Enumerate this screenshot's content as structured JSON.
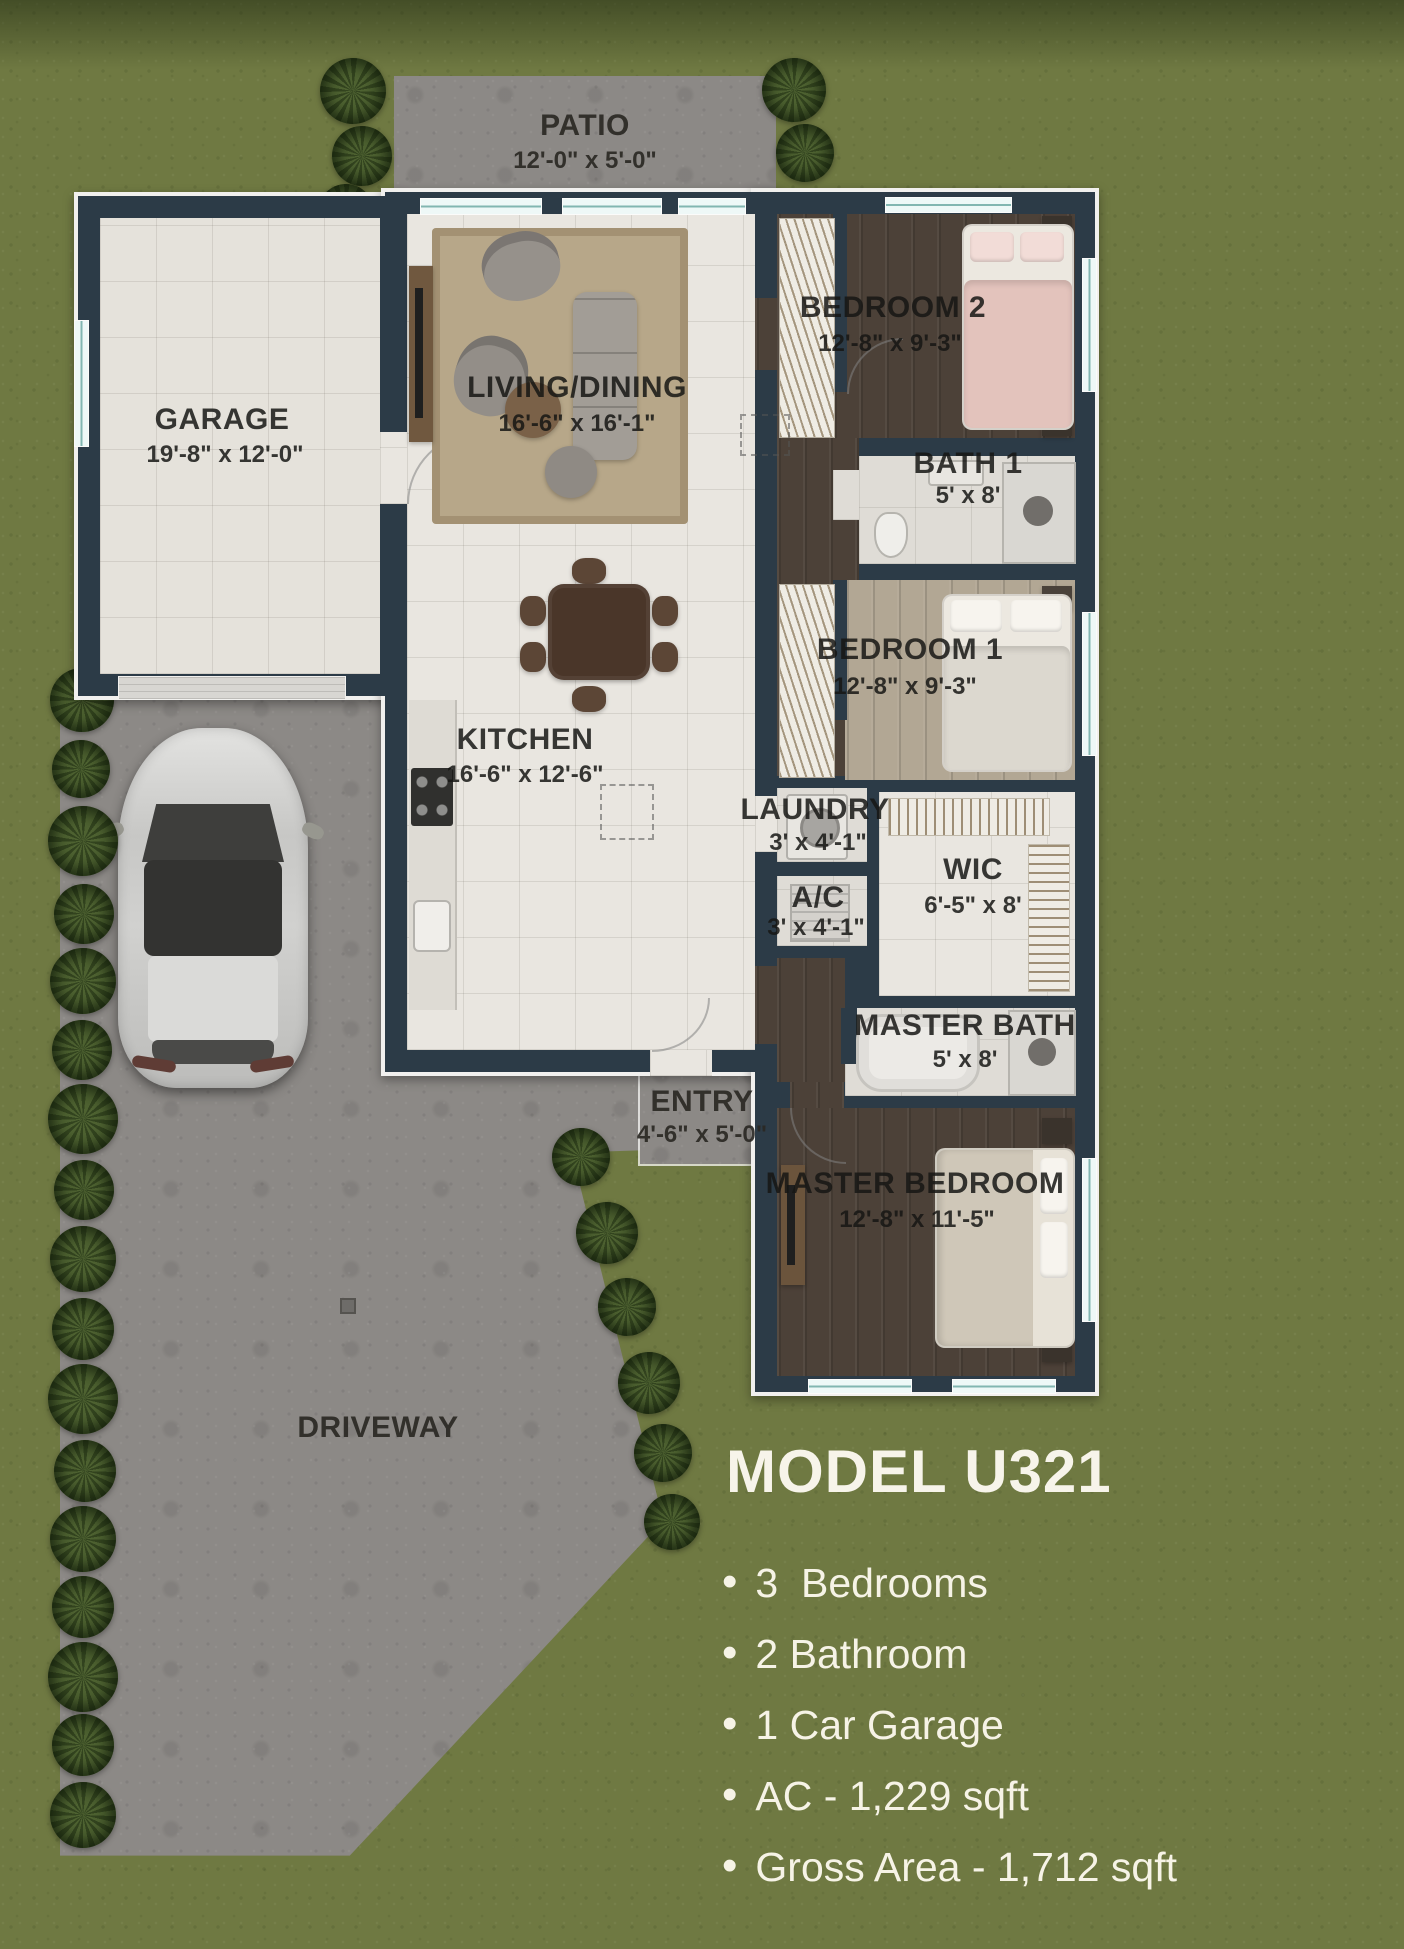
{
  "title": "MODEL U321",
  "features": [
    {
      "bullet": "•",
      "text": "3  Bedrooms"
    },
    {
      "bullet": "•",
      "text": "2 Bathroom"
    },
    {
      "bullet": "•",
      "text": "1 Car Garage"
    },
    {
      "bullet": "•",
      "text": "AC - 1,229 sqft"
    },
    {
      "bullet": "•",
      "text": "Gross Area - 1,712 sqft"
    }
  ],
  "rooms": {
    "patio": {
      "name": "PATIO",
      "dims": "12'-0\" x 5'-0\""
    },
    "garage": {
      "name": "GARAGE",
      "dims": "19'-8\" x 12'-0\""
    },
    "living_dining": {
      "name": "LIVING/DINING",
      "dims": "16'-6\" x 16'-1\""
    },
    "kitchen": {
      "name": "KITCHEN",
      "dims": "16'-6\" x 12'-6\""
    },
    "bedroom2": {
      "name": "BEDROOM 2",
      "dims": "12'-8\" x 9'-3\""
    },
    "bath1": {
      "name": "BATH 1",
      "dims": "5' x 8'"
    },
    "bedroom1": {
      "name": "BEDROOM 1",
      "dims": "12'-8\" x 9'-3\""
    },
    "laundry": {
      "name": "LAUNDRY",
      "dims": "3' x 4'-1\""
    },
    "wic": {
      "name": "WIC",
      "dims": "6'-5\" x 8'"
    },
    "ac": {
      "name": "A/C",
      "dims": "3' x 4'-1\""
    },
    "master_bath": {
      "name": "MASTER BATH",
      "dims": "5' x 8'"
    },
    "entry": {
      "name": "ENTRY",
      "dims": "4'-6\" x 5'-0\""
    },
    "master_bedroom": {
      "name": "MASTER BEDROOM",
      "dims": "12'-8\" x 11'-5\""
    },
    "driveway": {
      "name": "DRIVEWAY"
    }
  },
  "colors": {
    "grass": "#6f7942",
    "walls": "#2c3b47",
    "concrete": "#8c8986",
    "window_glass": "#82b6b1",
    "label_dark": "#161614",
    "label_light": "#f6f3e6"
  }
}
